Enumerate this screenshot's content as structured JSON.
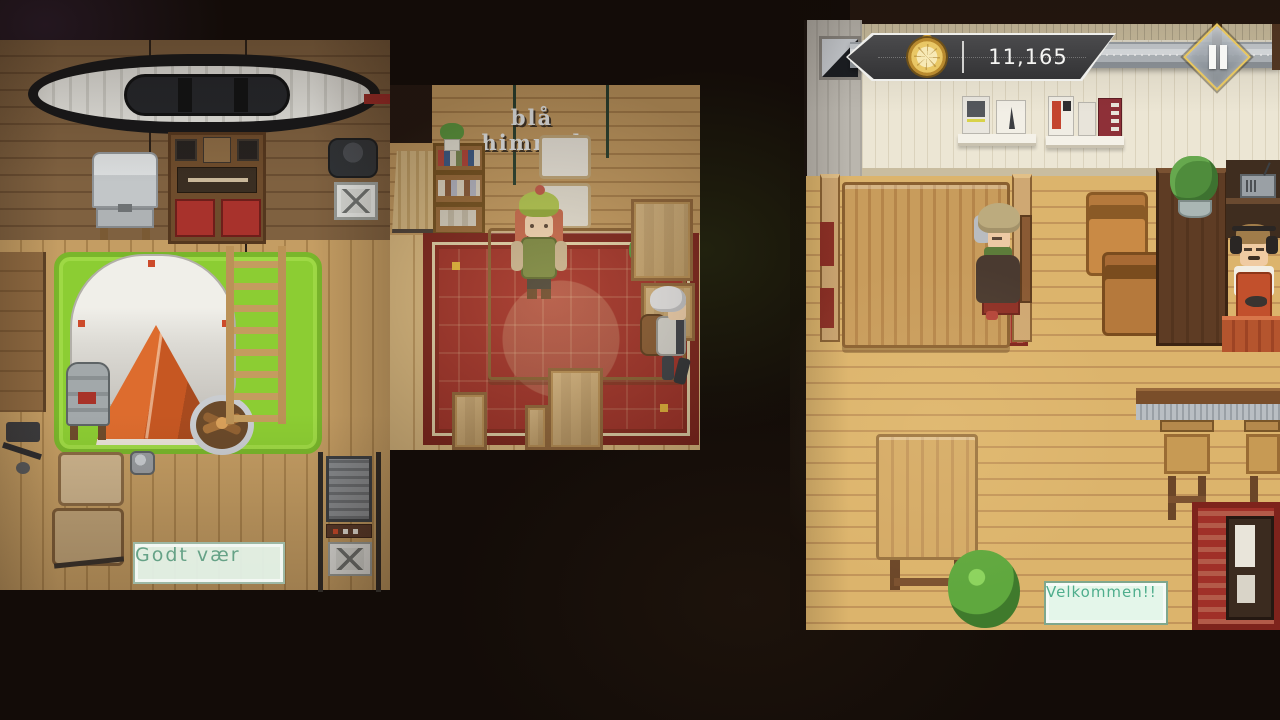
{
  "game": {
    "hud": {
      "clock_icon": "pocket-watch-icon",
      "money": "11,165",
      "pause_icon": "pause-icon"
    },
    "bubbles": {
      "sky_label": "blå himmel",
      "weather_label": "Godt vær",
      "welcome_speech": "Velkommen!!"
    },
    "colors": {
      "void_bg": "#130c08",
      "hud_panel": "#3e3e40",
      "hud_border": "#efefed",
      "gold_accent": "#e9c75e",
      "bubble_bg": "#e4f6ea",
      "bubble_text": "#4fae8d",
      "grass_green": "#8ccd33",
      "tent_orange": "#dd6c2e",
      "carpet_red": "#a23129",
      "cafe_wall": "#ece6d4",
      "wood_floor": "#dcb46c",
      "lamp_teal": "#2e5055"
    }
  }
}
